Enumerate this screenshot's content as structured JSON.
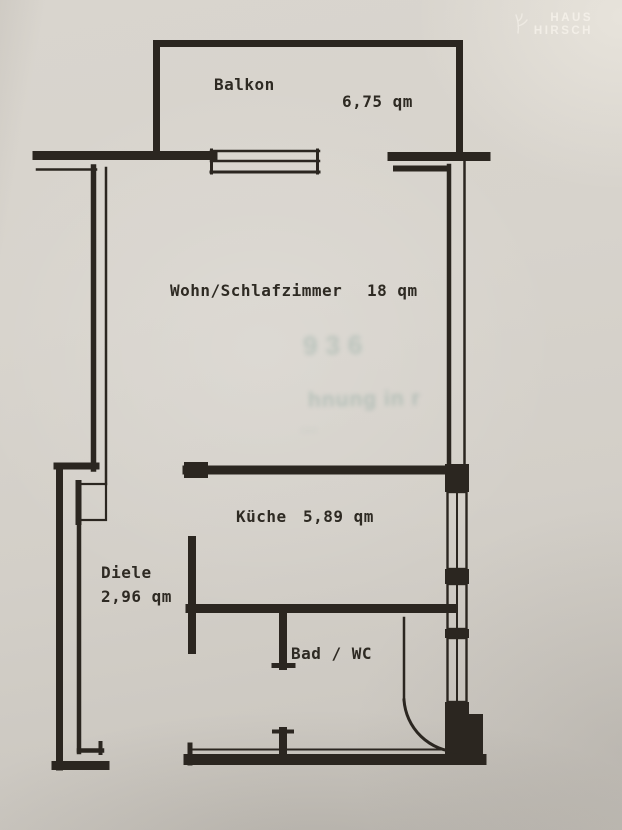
{
  "colors": {
    "paper": "#d6d2ca",
    "ink": "#2b2620",
    "label": "#2e2a23",
    "logo": "#f7f3ec",
    "ghost": "#6f968c"
  },
  "logo": {
    "line1": "HAUS",
    "line2": "HIRSCH"
  },
  "rooms": {
    "balkon": {
      "name": "Balkon",
      "area": "6,75 qm"
    },
    "wohnzimmer": {
      "name": "Wohn/Schlafzimmer",
      "area": "18 qm"
    },
    "kueche": {
      "name": "Küche",
      "area": "5,89 qm"
    },
    "diele": {
      "name": "Diele",
      "area": "2,96 qm"
    },
    "bad": {
      "name": "Bad / WC"
    }
  },
  "ghost_text": {
    "line1": "936",
    "line2": "hnung in r",
    "line3": "…"
  }
}
